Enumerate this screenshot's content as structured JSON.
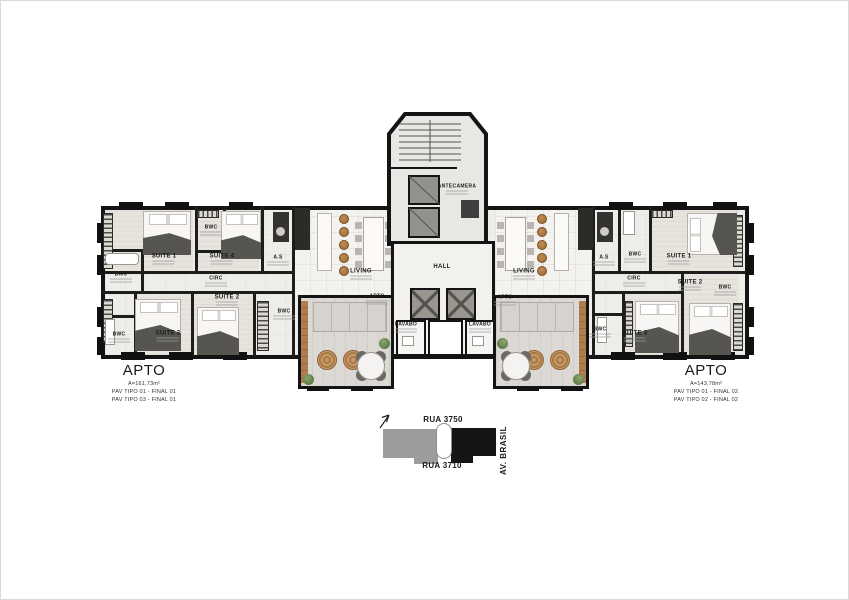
{
  "watermark": "A",
  "colors": {
    "wall": "#141414",
    "wood": "#a9713f",
    "floor": "#f1efec",
    "plant": "#5e7d49",
    "map_gray": "#9c9c9c",
    "map_black": "#141414"
  },
  "rooms": [
    {
      "id": "suite1-left",
      "label": "SUITE 1",
      "x": 163,
      "y": 258,
      "sub": true
    },
    {
      "id": "bwc-top-left",
      "label": "BWC",
      "x": 210,
      "y": 229,
      "sub": true,
      "small": true
    },
    {
      "id": "suite4-left",
      "label": "SUITE 4",
      "x": 221,
      "y": 258,
      "sub": true
    },
    {
      "id": "as-left",
      "label": "A.S",
      "x": 277,
      "y": 259,
      "sub": true,
      "small": true
    },
    {
      "id": "circ-left",
      "label": "CIRC",
      "x": 215,
      "y": 280,
      "sub": true,
      "small": true
    },
    {
      "id": "suite2-left",
      "label": "SUITE 2",
      "x": 226,
      "y": 299,
      "sub": true
    },
    {
      "id": "bwc-mid-left",
      "label": "BWC",
      "x": 120,
      "y": 276,
      "sub": true,
      "small": true
    },
    {
      "id": "bwc-bottom-left",
      "label": "BWC",
      "x": 118,
      "y": 336,
      "sub": true,
      "small": true
    },
    {
      "id": "suite3-left",
      "label": "SUITE 3",
      "x": 167,
      "y": 335,
      "sub": true
    },
    {
      "id": "bwc-inner-left",
      "label": "BWC",
      "x": 283,
      "y": 313,
      "sub": true,
      "small": true
    },
    {
      "id": "living-left",
      "label": "LIVING",
      "x": 360,
      "y": 273,
      "sub": true
    },
    {
      "id": "apto-left-inner",
      "label": "APTO",
      "x": 376,
      "y": 298,
      "sub": true,
      "small": true
    },
    {
      "id": "lavabo-left",
      "label": "LAVABO",
      "x": 405,
      "y": 326,
      "sub": true,
      "small": true
    },
    {
      "id": "hall",
      "label": "HALL",
      "x": 441,
      "y": 266
    },
    {
      "id": "antecamera",
      "label": "ANTECAMERA",
      "x": 456,
      "y": 188,
      "sub": true,
      "small": true
    },
    {
      "id": "lavabo-right",
      "label": "LAVABO",
      "x": 479,
      "y": 326,
      "sub": true,
      "small": true
    },
    {
      "id": "apto-right-inner",
      "label": "APTO",
      "x": 504,
      "y": 299,
      "sub": true,
      "small": true
    },
    {
      "id": "living-right",
      "label": "LIVING",
      "x": 523,
      "y": 273,
      "sub": true
    },
    {
      "id": "as-right",
      "label": "A.S",
      "x": 603,
      "y": 259,
      "sub": true,
      "small": true
    },
    {
      "id": "bwc-top-right",
      "label": "BWC",
      "x": 634,
      "y": 256,
      "sub": true,
      "small": true
    },
    {
      "id": "suite1-right",
      "label": "SUITE 1",
      "x": 678,
      "y": 258,
      "sub": true
    },
    {
      "id": "circ-right",
      "label": "CIRC",
      "x": 633,
      "y": 280,
      "sub": true,
      "small": true
    },
    {
      "id": "suite2-right",
      "label": "SUITE 2",
      "x": 689,
      "y": 284,
      "sub": true
    },
    {
      "id": "bwc-right-edge",
      "label": "BWC",
      "x": 724,
      "y": 289,
      "sub": true,
      "small": true
    },
    {
      "id": "bwc-bottom-right",
      "label": "BWC",
      "x": 599,
      "y": 331,
      "sub": true,
      "small": true
    },
    {
      "id": "suite3-right",
      "label": "SUITE 3",
      "x": 634,
      "y": 335,
      "sub": true
    }
  ],
  "apto_blocks": {
    "left": {
      "title": "APTO",
      "area": "A=161,73m²",
      "lines": [
        "PAV TIPO 01 - FINAL 01",
        "PAV TIPO 03 - FINAL 01"
      ]
    },
    "right": {
      "title": "APTO",
      "area": "A=143,78m²",
      "lines": [
        "PAV TIPO 01 - FINAL 02",
        "PAV TIPO 02 - FINAL 02"
      ]
    }
  },
  "locator": {
    "street_top": "RUA 3750",
    "street_bottom": "RUA 3710",
    "avenue": "AV. BRASIL"
  }
}
